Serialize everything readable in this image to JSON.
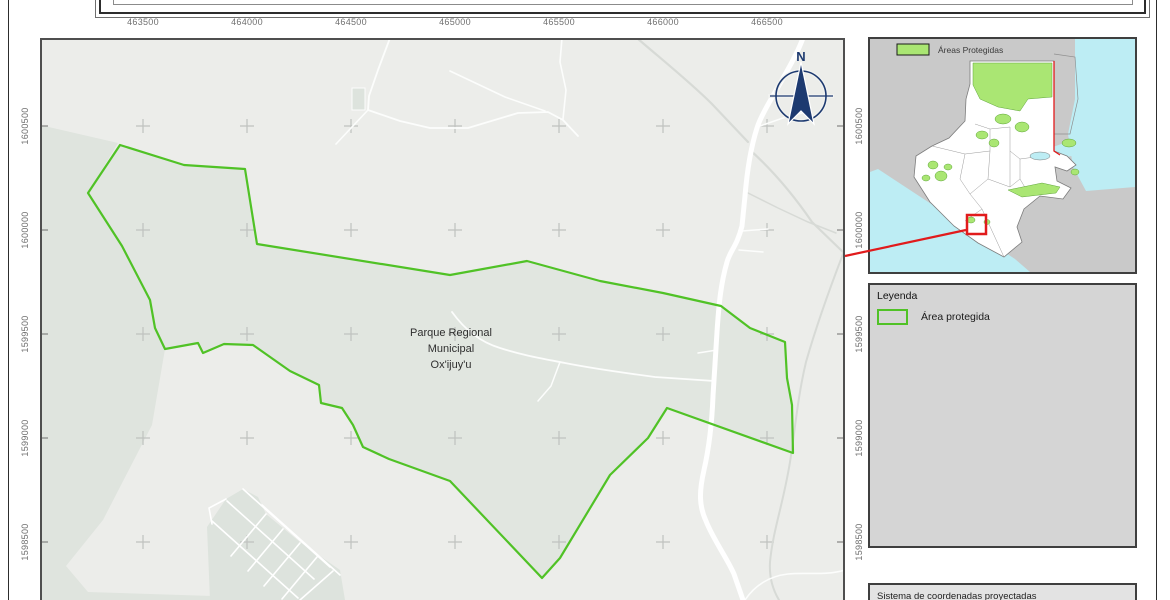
{
  "main_map": {
    "top_labels": [
      "463500",
      "464000",
      "464500",
      "465000",
      "465500",
      "466000",
      "466500"
    ],
    "side_labels": [
      "1600500",
      "1600000",
      "1599500",
      "1599000",
      "1598500"
    ],
    "park_label_lines": [
      "Parque Regional",
      "Municipal",
      "Ox'ijuy'u"
    ],
    "north_label": "N"
  },
  "inset": {
    "legend_label": "Áreas Protegidas"
  },
  "legend": {
    "title": "Leyenda",
    "items": [
      {
        "label": "Área protegida"
      }
    ]
  },
  "info_box": {
    "text": "Sistema de coordenadas proyectadas"
  },
  "colors": {
    "park_outline": "#50c226",
    "protected_area_fill": "#aae673",
    "locator_red": "#e11b1c",
    "north_arrow_navy": "#1d3a70",
    "water": "#bdedf4",
    "map_background": "#ecedea",
    "terrain_tint": "#dfe4de"
  }
}
